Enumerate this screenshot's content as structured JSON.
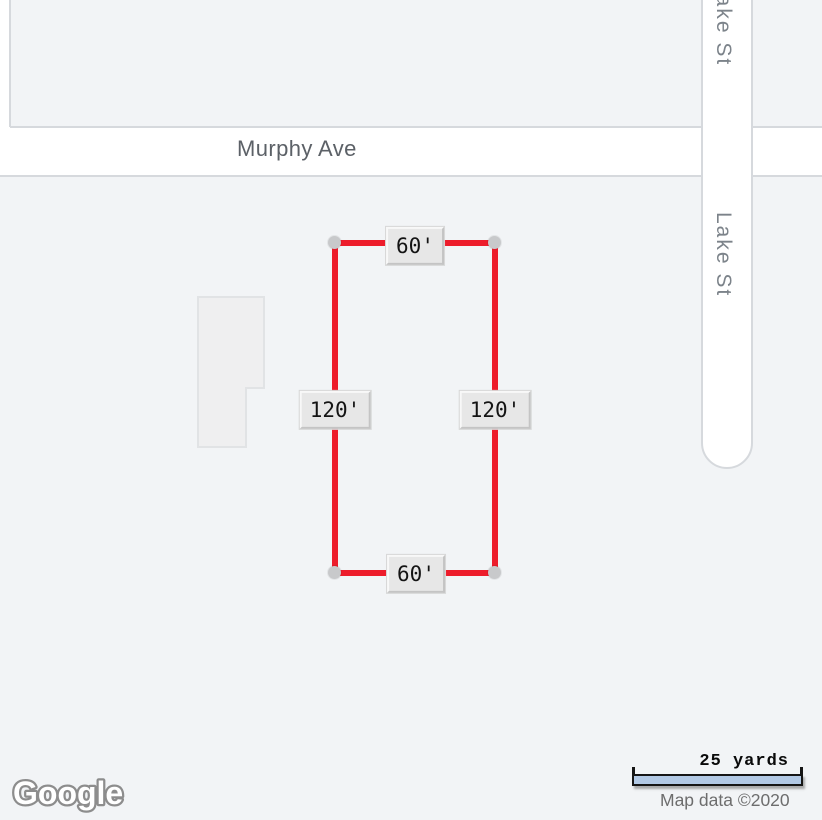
{
  "map": {
    "road_labels": {
      "horizontal": "Murphy Ave",
      "vertical_top": "Lake St",
      "vertical_bottom": "Lake St"
    },
    "measurements": {
      "top": "60'",
      "bottom": "60'",
      "left": "120'",
      "right": "120'"
    }
  },
  "scale": {
    "label": "25 yards"
  },
  "attribution": {
    "logo": "Google",
    "map_data": "Map data ©2020"
  },
  "colors": {
    "accent-red": "#ed1c2b",
    "road-fill": "#ffffff",
    "road-border": "#d6d9dd",
    "block-fill": "#f2f4f6",
    "building-fill": "#efeff0",
    "building-border": "#e1e3e5",
    "marker-dot": "#c8c9cb",
    "label-box-bg": "#e7e7e7",
    "label-box-light": "#f8f8f8",
    "label-box-dark": "#c4c4c4",
    "road-label": "#5c6167",
    "street-label": "#7c838a",
    "scalebar-fill": "#b2c9e5",
    "scalebar-border": "#161616",
    "attribution-text": "#6d6d6d",
    "logo-stroke": "#8d8d8d"
  }
}
